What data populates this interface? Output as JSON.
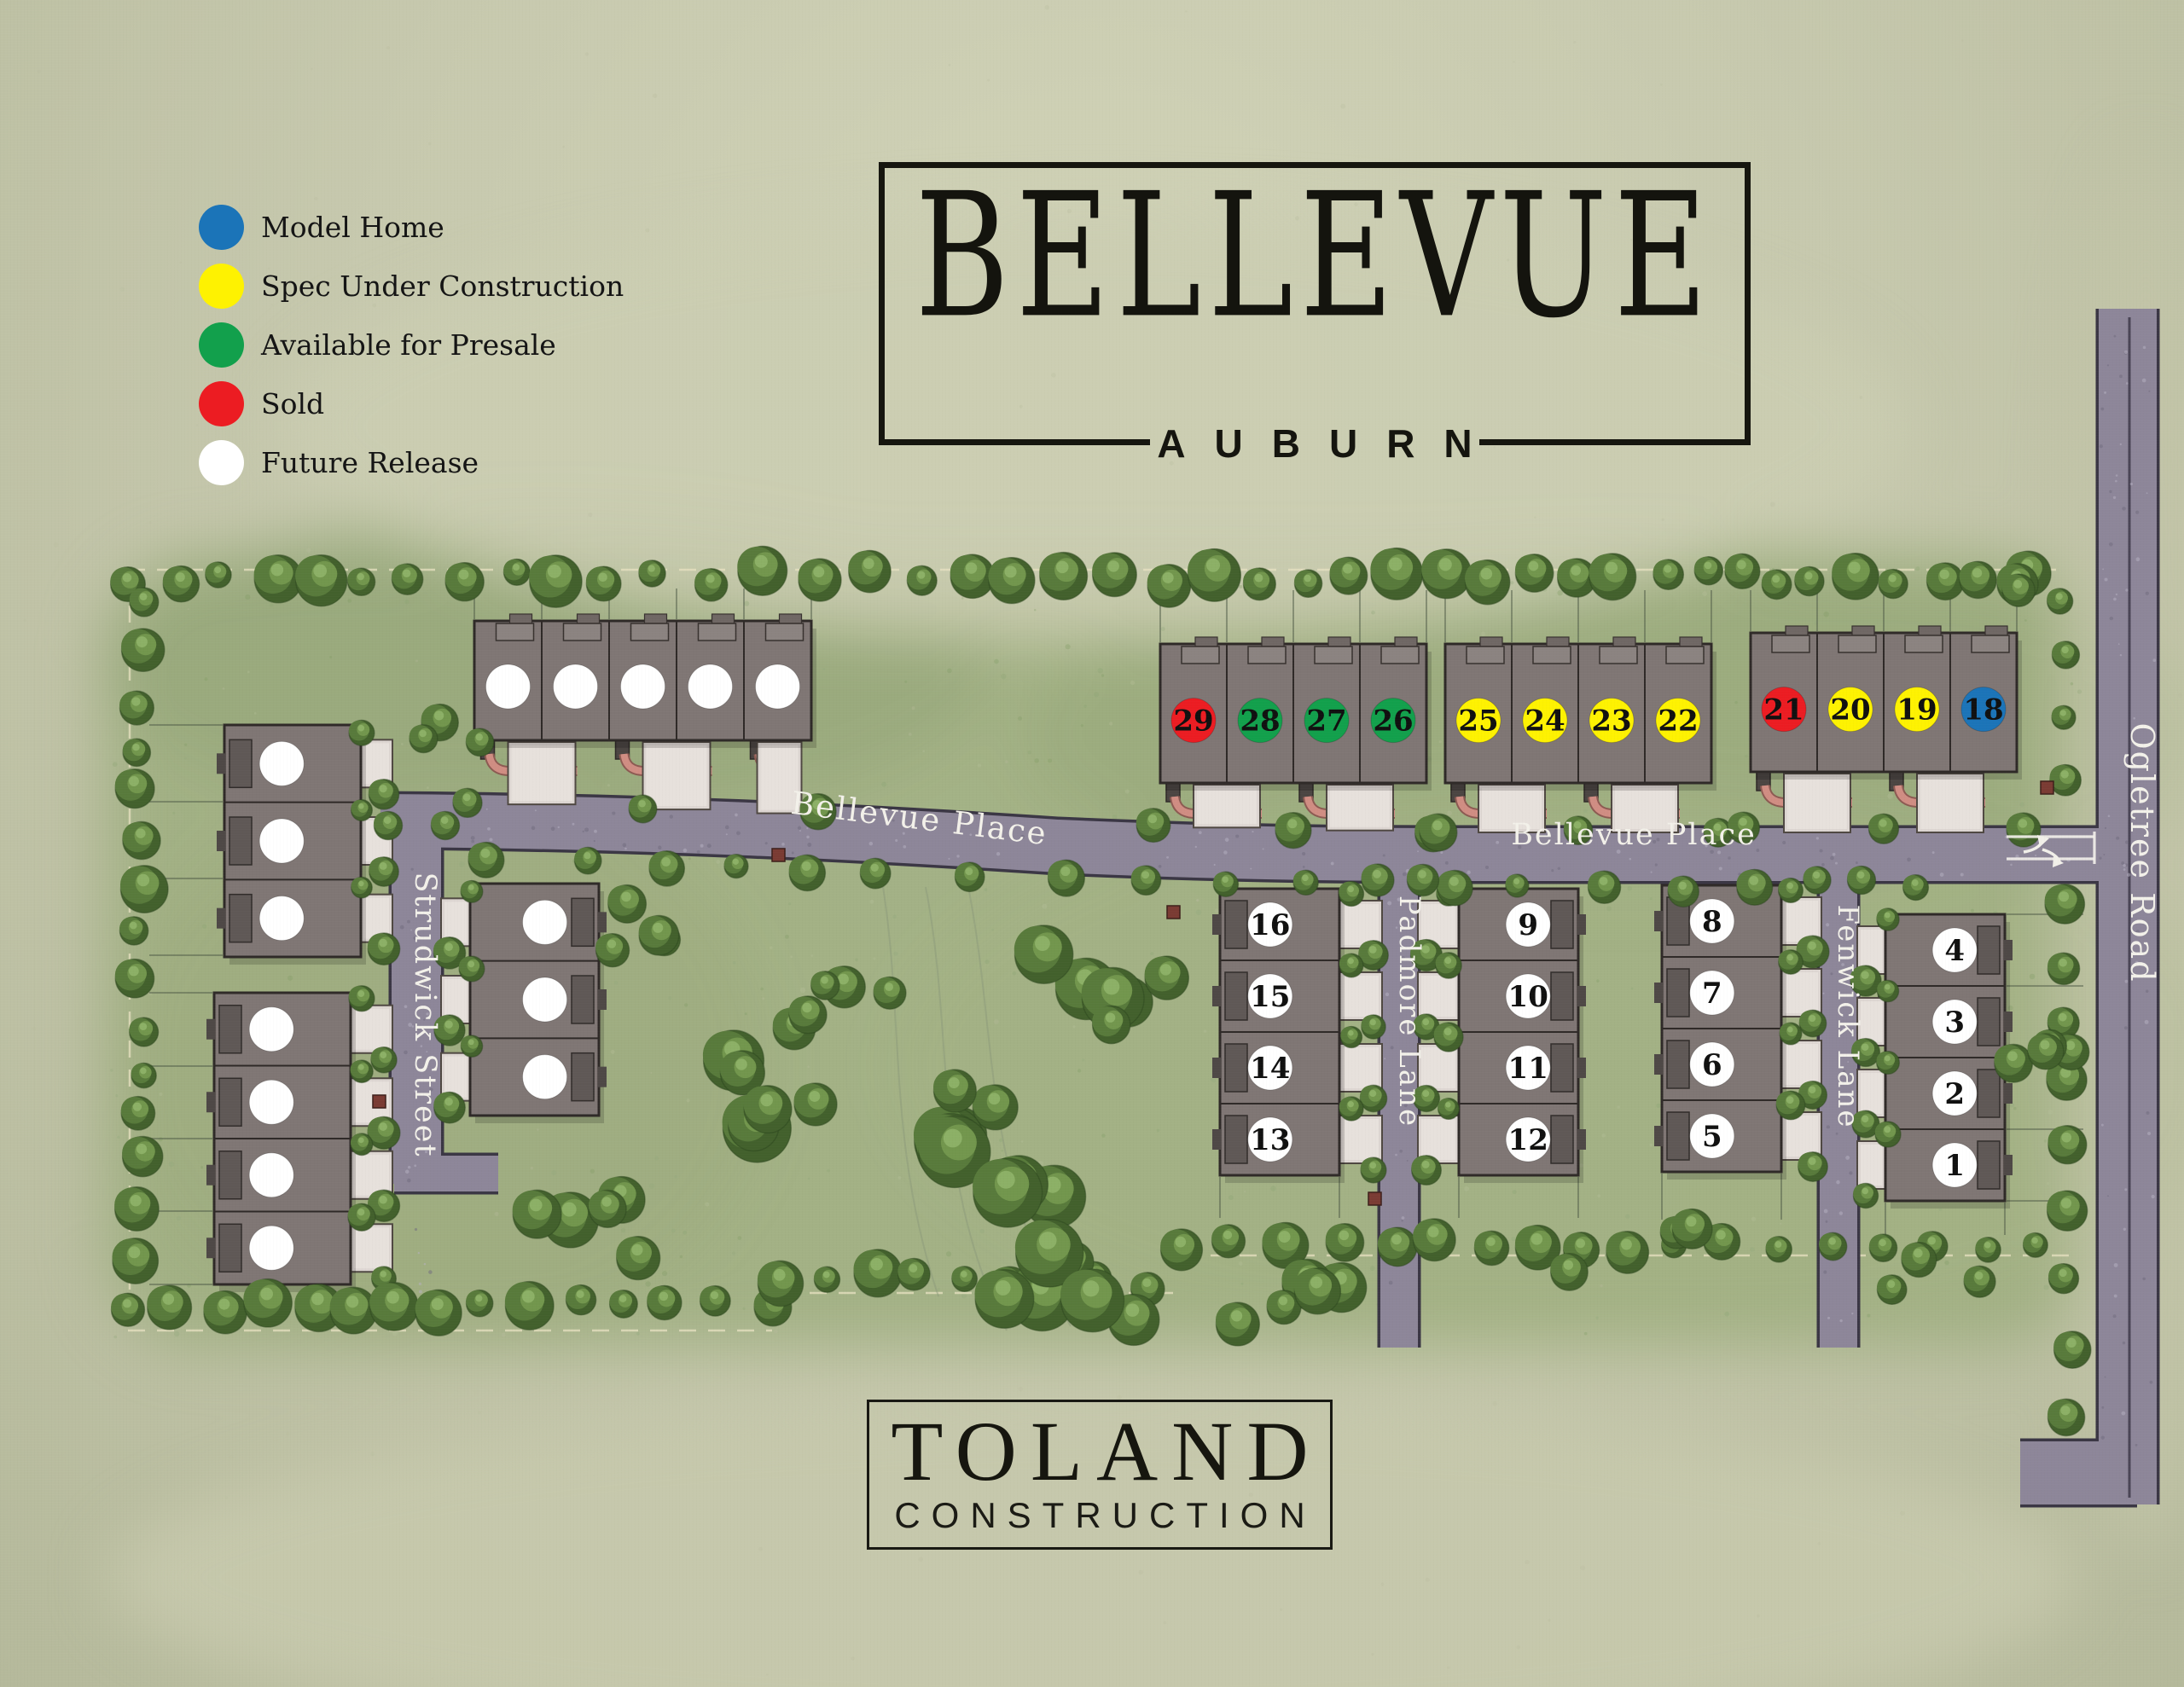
{
  "title": {
    "name": "BELLEVUE",
    "location": "AUBURN"
  },
  "builder": {
    "name": "TOLAND",
    "division": "CONSTRUCTION"
  },
  "legend": {
    "items": [
      {
        "status": "model",
        "label": "Model Home",
        "color": "#1b74b8"
      },
      {
        "status": "spec",
        "label": "Spec Under Construction",
        "color": "#fef201"
      },
      {
        "status": "presale",
        "label": "Available for Presale",
        "color": "#12a04c"
      },
      {
        "status": "sold",
        "label": "Sold",
        "color": "#ec1c22"
      },
      {
        "status": "future",
        "label": "Future Release",
        "color": "#ffffff"
      }
    ]
  },
  "streets": [
    {
      "id": "bellevue-place-west",
      "name": "Bellevue Place"
    },
    {
      "id": "bellevue-place-east",
      "name": "Bellevue Place"
    },
    {
      "id": "strudwick-street",
      "name": "Strudwick Street"
    },
    {
      "id": "padmore-lane",
      "name": "Padmore Lane"
    },
    {
      "id": "fenwick-lane",
      "name": "Fenwick Lane"
    },
    {
      "id": "ogletree-road",
      "name": "Ogletree Road"
    }
  ],
  "buildings": [
    {
      "id": "bldg-29-26",
      "units": [
        {
          "lot": "29",
          "status": "sold"
        },
        {
          "lot": "28",
          "status": "presale"
        },
        {
          "lot": "27",
          "status": "presale"
        },
        {
          "lot": "26",
          "status": "presale"
        }
      ]
    },
    {
      "id": "bldg-25-22",
      "units": [
        {
          "lot": "25",
          "status": "spec"
        },
        {
          "lot": "24",
          "status": "spec"
        },
        {
          "lot": "23",
          "status": "spec"
        },
        {
          "lot": "22",
          "status": "spec"
        }
      ]
    },
    {
      "id": "bldg-21-18",
      "units": [
        {
          "lot": "21",
          "status": "sold"
        },
        {
          "lot": "20",
          "status": "spec"
        },
        {
          "lot": "19",
          "status": "spec"
        },
        {
          "lot": "18",
          "status": "model"
        }
      ]
    },
    {
      "id": "bldg-future-north",
      "units": [
        {
          "lot": "",
          "status": "future"
        },
        {
          "lot": "",
          "status": "future"
        },
        {
          "lot": "",
          "status": "future"
        },
        {
          "lot": "",
          "status": "future"
        },
        {
          "lot": "",
          "status": "future"
        }
      ]
    },
    {
      "id": "bldg-16-13",
      "units": [
        {
          "lot": "16",
          "status": "future"
        },
        {
          "lot": "15",
          "status": "future"
        },
        {
          "lot": "14",
          "status": "future"
        },
        {
          "lot": "13",
          "status": "future"
        }
      ]
    },
    {
      "id": "bldg-9-12",
      "units": [
        {
          "lot": "9",
          "status": "future"
        },
        {
          "lot": "10",
          "status": "future"
        },
        {
          "lot": "11",
          "status": "future"
        },
        {
          "lot": "12",
          "status": "future"
        }
      ]
    },
    {
      "id": "bldg-8-5",
      "units": [
        {
          "lot": "8",
          "status": "future"
        },
        {
          "lot": "7",
          "status": "future"
        },
        {
          "lot": "6",
          "status": "future"
        },
        {
          "lot": "5",
          "status": "future"
        }
      ]
    },
    {
      "id": "bldg-4-1",
      "units": [
        {
          "lot": "4",
          "status": "future"
        },
        {
          "lot": "3",
          "status": "future"
        },
        {
          "lot": "2",
          "status": "future"
        },
        {
          "lot": "1",
          "status": "future"
        }
      ]
    },
    {
      "id": "bldg-future-west-a",
      "units": [
        {
          "lot": "",
          "status": "future"
        },
        {
          "lot": "",
          "status": "future"
        },
        {
          "lot": "",
          "status": "future"
        }
      ]
    },
    {
      "id": "bldg-future-west-b",
      "units": [
        {
          "lot": "",
          "status": "future"
        },
        {
          "lot": "",
          "status": "future"
        },
        {
          "lot": "",
          "status": "future"
        },
        {
          "lot": "",
          "status": "future"
        }
      ]
    },
    {
      "id": "bldg-future-east-strudwick",
      "units": [
        {
          "lot": "",
          "status": "future"
        },
        {
          "lot": "",
          "status": "future"
        },
        {
          "lot": "",
          "status": "future"
        }
      ]
    }
  ]
}
